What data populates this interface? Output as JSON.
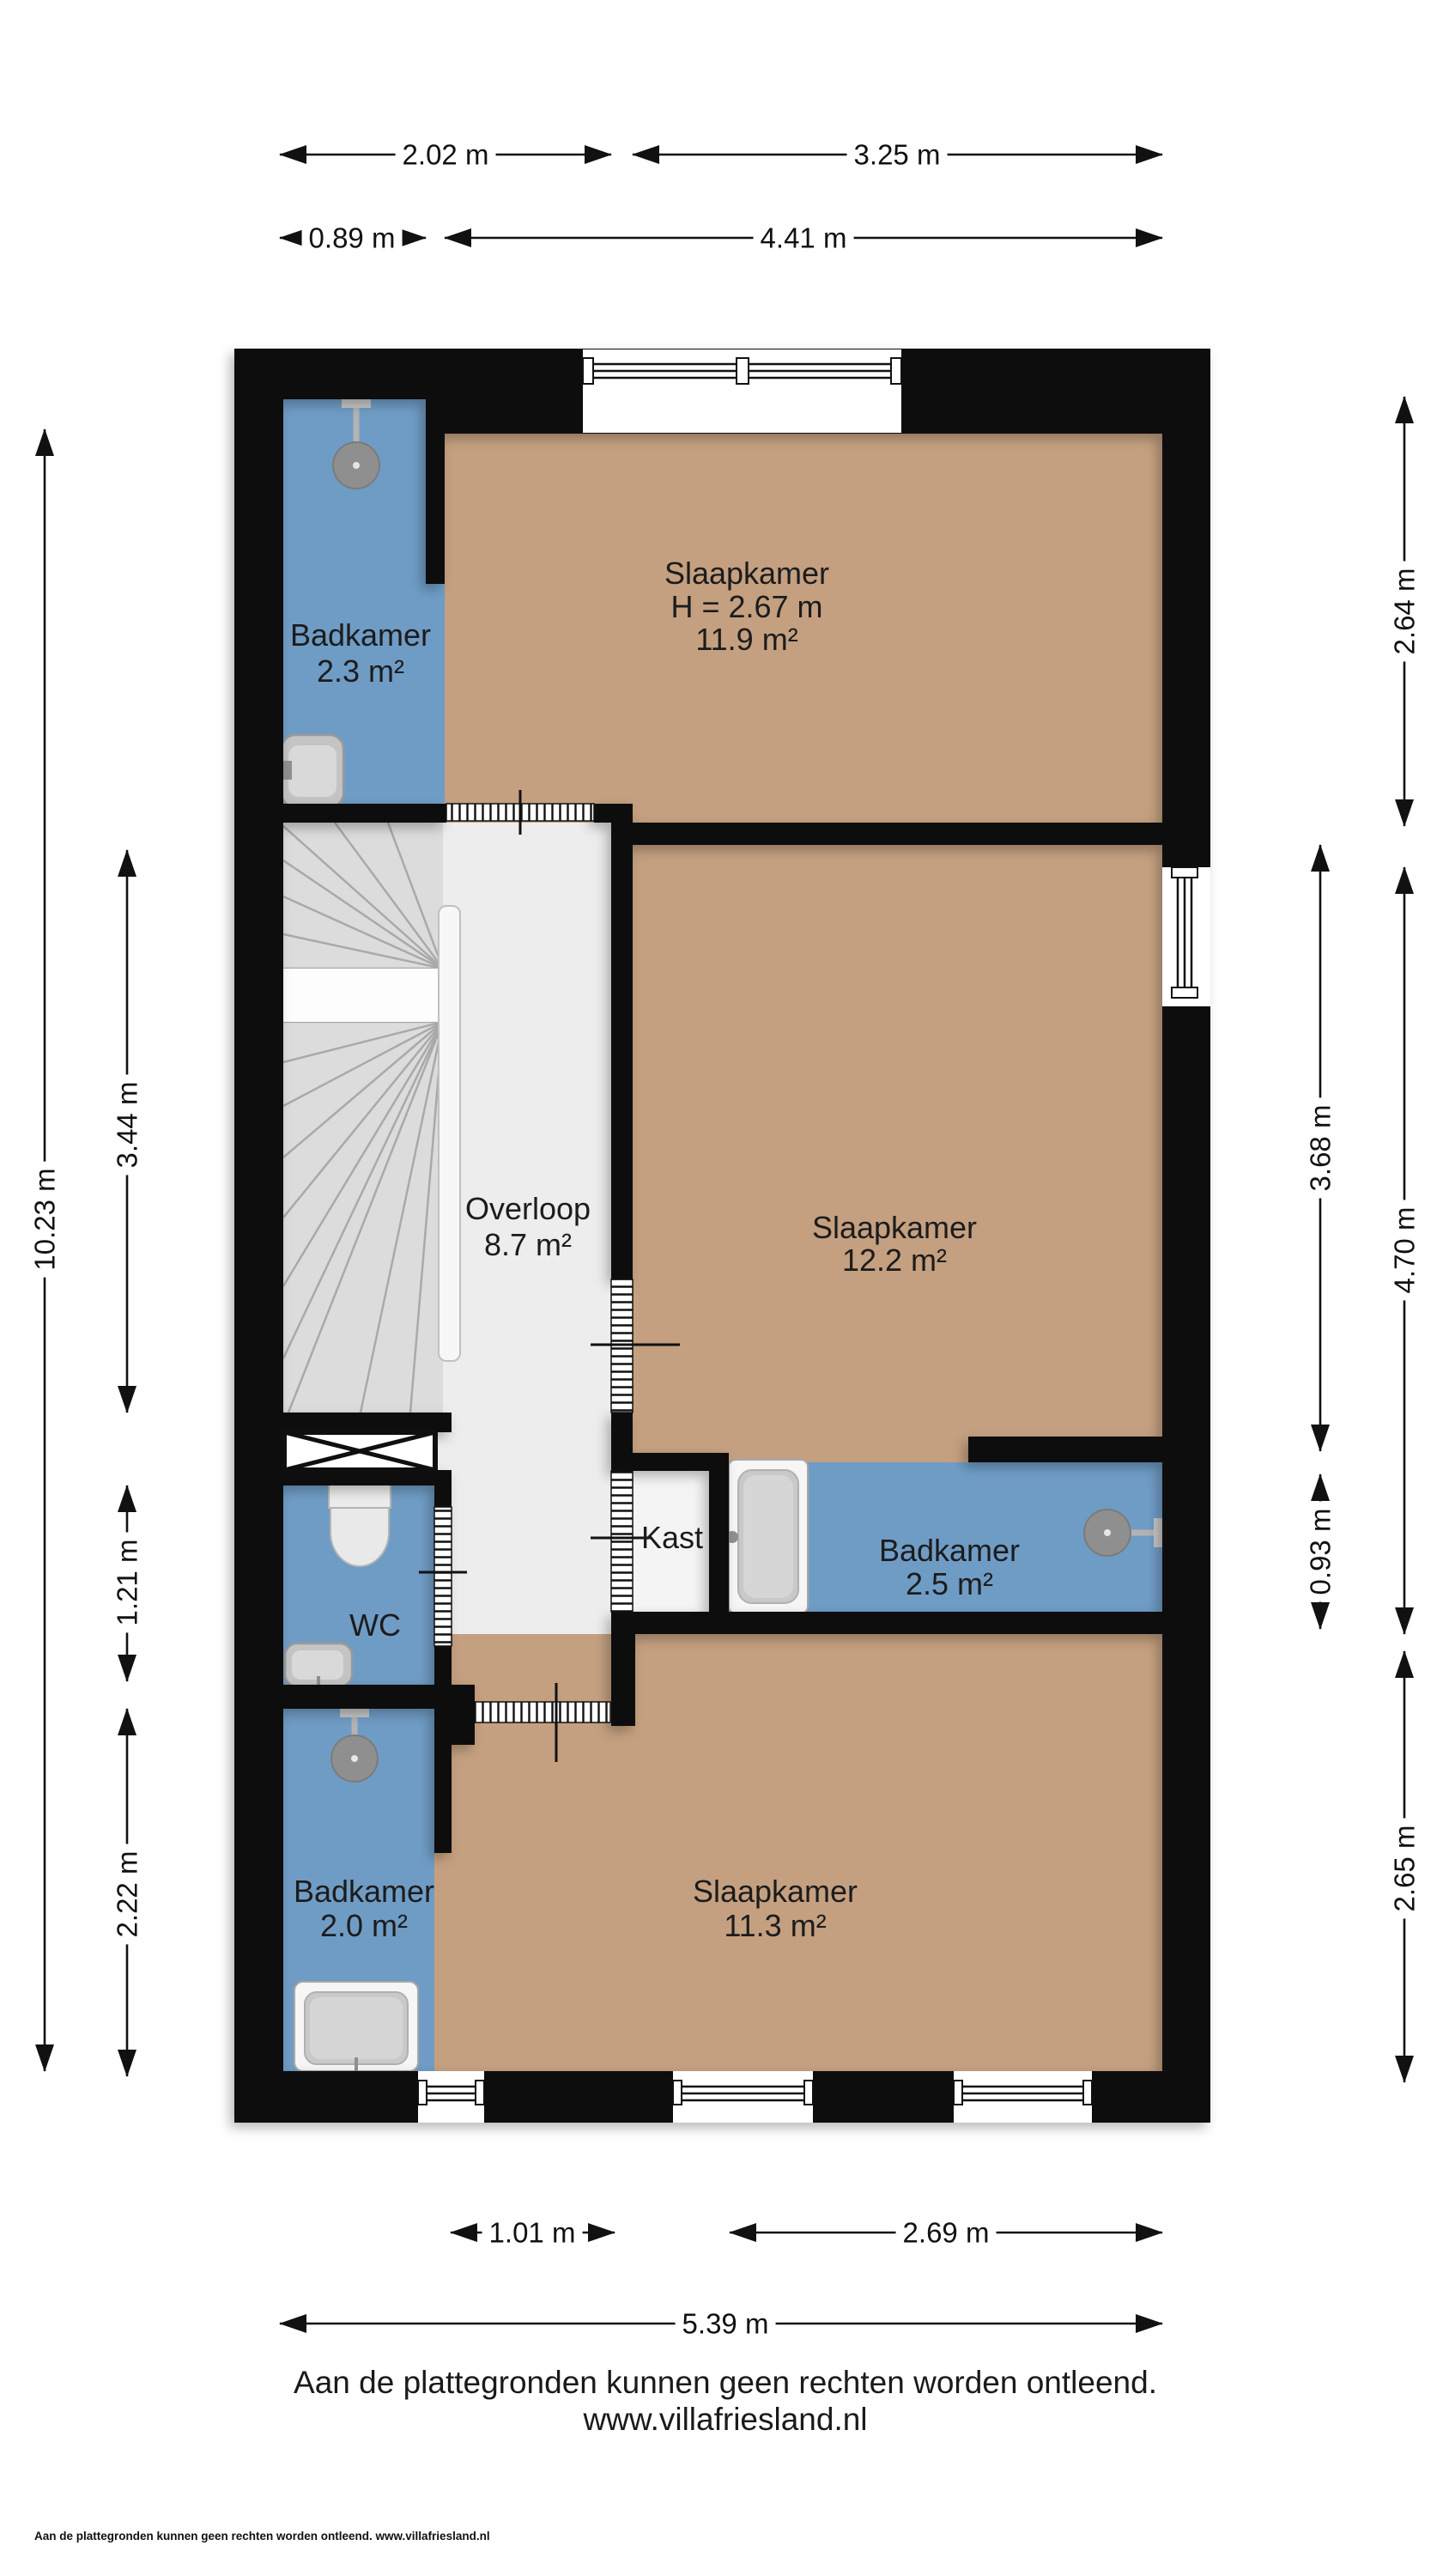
{
  "title": "Floor plan first floor (verdieping)",
  "rooms": {
    "badkamer_top": {
      "name": "Badkamer",
      "area": "2.3 m²"
    },
    "slaapkamer_top": {
      "name": "Slaapkamer",
      "ceiling": "H = 2.67 m",
      "area": "11.9 m²"
    },
    "overloop": {
      "name": "Overloop",
      "area": "8.7 m²"
    },
    "slaapkamer_mid": {
      "name": "Slaapkamer",
      "area": "12.2 m²"
    },
    "kast": {
      "name": "Kast"
    },
    "badkamer_mid": {
      "name": "Badkamer",
      "area": "2.5 m²"
    },
    "wc": {
      "name": "WC"
    },
    "badkamer_bottom": {
      "name": "Badkamer",
      "area": "2.0 m²"
    },
    "slaapkamer_bottom": {
      "name": "Slaapkamer",
      "area": "11.3 m²"
    }
  },
  "dims": {
    "top1_left": "2.02 m",
    "top1_right": "3.25 m",
    "top2_left": "0.89 m",
    "top2_right": "4.41 m",
    "left_total": "10.23 m",
    "left_stairs": "3.44 m",
    "left_wc": "1.21 m",
    "left_bath": "2.22 m",
    "right_outer_top": "2.64 m",
    "right_outer_mid": "4.70 m",
    "right_outer_bottom": "2.65 m",
    "right_inner_top": "3.68 m",
    "right_inner_mid": "0.93 m",
    "bottom_left": "1.01 m",
    "bottom_right": "2.69 m",
    "bottom_total": "5.39 m"
  },
  "footer": {
    "disclaimer": "Aan de plattegronden kunnen geen rechten worden ontleend.",
    "website": "www.villafriesland.nl",
    "small_print": "Aan de plattegronden kunnen geen rechten worden ontleend. www.villafriesland.nl"
  },
  "colors": {
    "floor_bedroom": "#c4a080",
    "floor_bathroom": "#6f9cc5",
    "floor_hall": "#ededed",
    "floor_closet": "#f4f4f4",
    "wall": "#0f0f0f",
    "stairs": "#dcdcdc",
    "fixture_gray": "#8f8f8f"
  },
  "icons": {
    "shower": "shower-head-icon",
    "bathtub": "bathtub-icon",
    "toilet": "toilet-icon",
    "sink": "sink-icon",
    "window": "window-icon",
    "door": "door-opening-icon"
  }
}
